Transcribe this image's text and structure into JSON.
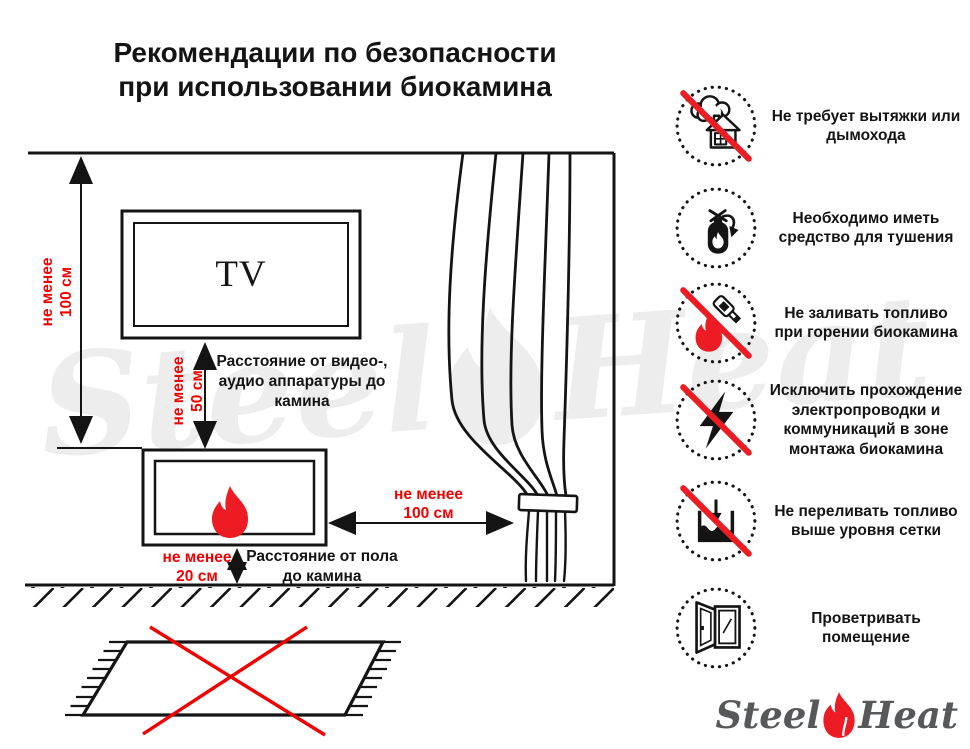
{
  "title": {
    "line1": "Рекомендации по безопасности",
    "line2": "при использовании биокамина"
  },
  "diagram": {
    "tv": "TV",
    "dim_wall": {
      "l1": "не менее",
      "l2": "100 см"
    },
    "dim_tv": {
      "l1": "не менее",
      "l2": "50 см"
    },
    "dim_curtain": {
      "l1": "не менее",
      "l2": "100 см"
    },
    "dim_floor": {
      "l1": "не менее",
      "l2": "20 см"
    },
    "label_av": "Расстояние от видео-, аудио аппаратуры до камина",
    "label_floor": "Расстояние от пола до камина"
  },
  "rules": [
    {
      "icon": "no-chimney-icon",
      "prohibited": true,
      "text": "Не требует вытяжки или дымохода"
    },
    {
      "icon": "extinguisher-icon",
      "prohibited": false,
      "text": "Необходимо иметь средство для тушения"
    },
    {
      "icon": "no-refuel-burning-icon",
      "prohibited": true,
      "text": "Не заливать топливо при горении биокамина"
    },
    {
      "icon": "no-wiring-icon",
      "prohibited": true,
      "text": "Исключить прохождение электропроводки и коммуникаций в зоне монтажа биокамина"
    },
    {
      "icon": "no-overfill-icon",
      "prohibited": true,
      "text": "Не переливать топливо выше уровня сетки"
    },
    {
      "icon": "ventilate-icon",
      "prohibited": false,
      "text": "Проветривать помещение"
    }
  ],
  "logo": {
    "steel": "Steel",
    "heat": "Heat"
  },
  "watermark": {
    "steel": "Steel",
    "heat": "Heat"
  },
  "colors": {
    "red": "#f20000",
    "accent": "#ed1c24",
    "ink": "#141414",
    "logoGray": "#57585a",
    "watermarkGray": "#ededed"
  }
}
